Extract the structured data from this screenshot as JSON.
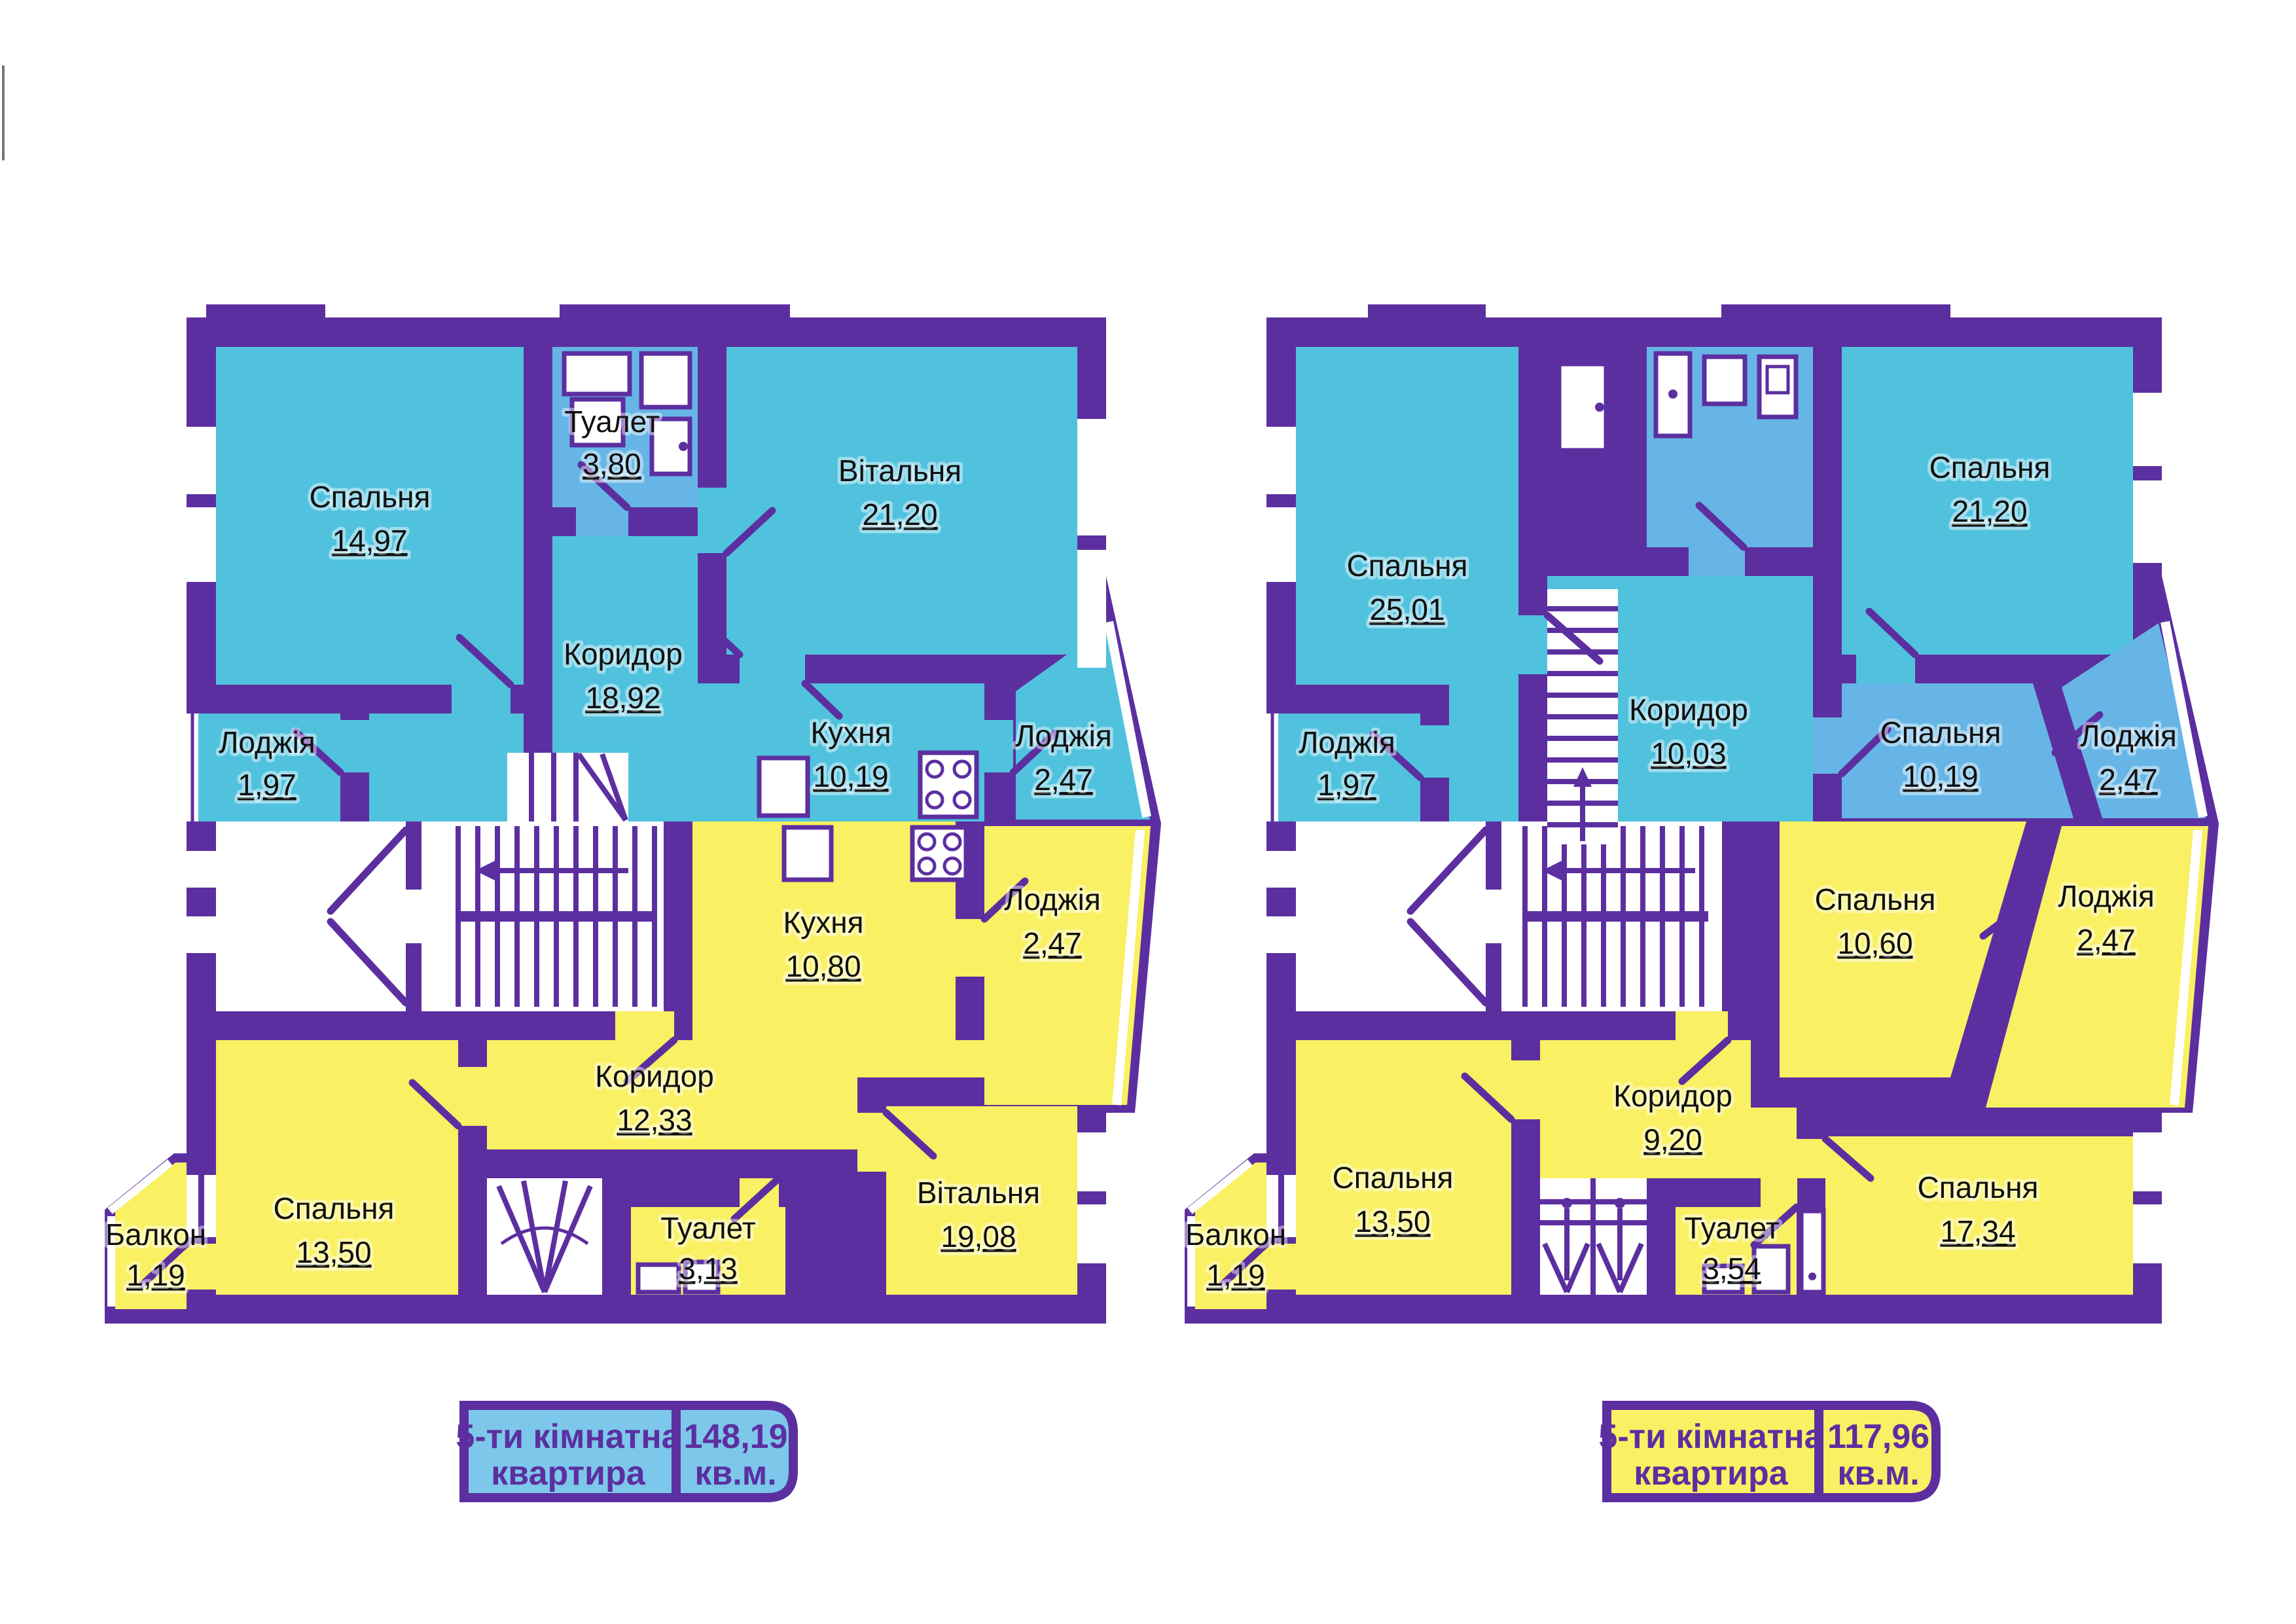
{
  "colors": {
    "wall": "#5C2FA0",
    "floor_upper": "#50C2DE",
    "floor_upper_alt": "#66B5E6",
    "floor_lower": "#F9F063",
    "badge_left_bg": "#7CC7EA",
    "badge_right_bg": "#F9F063",
    "badge_text": "#5C2FA0",
    "room_text": "#101010"
  },
  "plans": {
    "left": {
      "rooms_upper": [
        {
          "name": "Спальня",
          "area": "14,97"
        },
        {
          "name": "Туалет",
          "area": "3,80"
        },
        {
          "name": "Вітальня",
          "area": "21,20"
        },
        {
          "name": "Коридор",
          "area": "18,92"
        },
        {
          "name": "Лоджія",
          "area": "1,97"
        },
        {
          "name": "Кухня",
          "area": "10,19"
        },
        {
          "name": "Лоджія",
          "area": "2,47"
        }
      ],
      "rooms_lower": [
        {
          "name": "Кухня",
          "area": "10,80"
        },
        {
          "name": "Лоджія",
          "area": "2,47"
        },
        {
          "name": "Коридор",
          "area": "12,33"
        },
        {
          "name": "Спальня",
          "area": "13,50"
        },
        {
          "name": "Балкон",
          "area": "1,19"
        },
        {
          "name": "Туалет",
          "area": "3,13"
        },
        {
          "name": "Вітальня",
          "area": "19,08"
        }
      ],
      "badge": {
        "type_line1": "5-ти кімнатна",
        "type_line2": "квартира",
        "area": "148,19",
        "unit": "кв.м."
      }
    },
    "right": {
      "rooms_upper": [
        {
          "name": "Спальня",
          "area": "25,01"
        },
        {
          "name": "Коридор",
          "area": "10,03"
        },
        {
          "name": "Спальня",
          "area": "21,20"
        },
        {
          "name": "Спальня",
          "area": "10,19"
        },
        {
          "name": "Лоджія",
          "area": "2,47"
        },
        {
          "name": "Лоджія",
          "area": "1,97"
        }
      ],
      "rooms_lower": [
        {
          "name": "Спальня",
          "area": "10,60"
        },
        {
          "name": "Лоджія",
          "area": "2,47"
        },
        {
          "name": "Коридор",
          "area": "9,20"
        },
        {
          "name": "Спальня",
          "area": "13,50"
        },
        {
          "name": "Балкон",
          "area": "1,19"
        },
        {
          "name": "Туалет",
          "area": "3,54"
        },
        {
          "name": "Спальня",
          "area": "17,34"
        }
      ],
      "badge": {
        "type_line1": "5-ти кімнатна",
        "type_line2": "квартира",
        "area": "117,96",
        "unit": "кв.м."
      }
    }
  }
}
